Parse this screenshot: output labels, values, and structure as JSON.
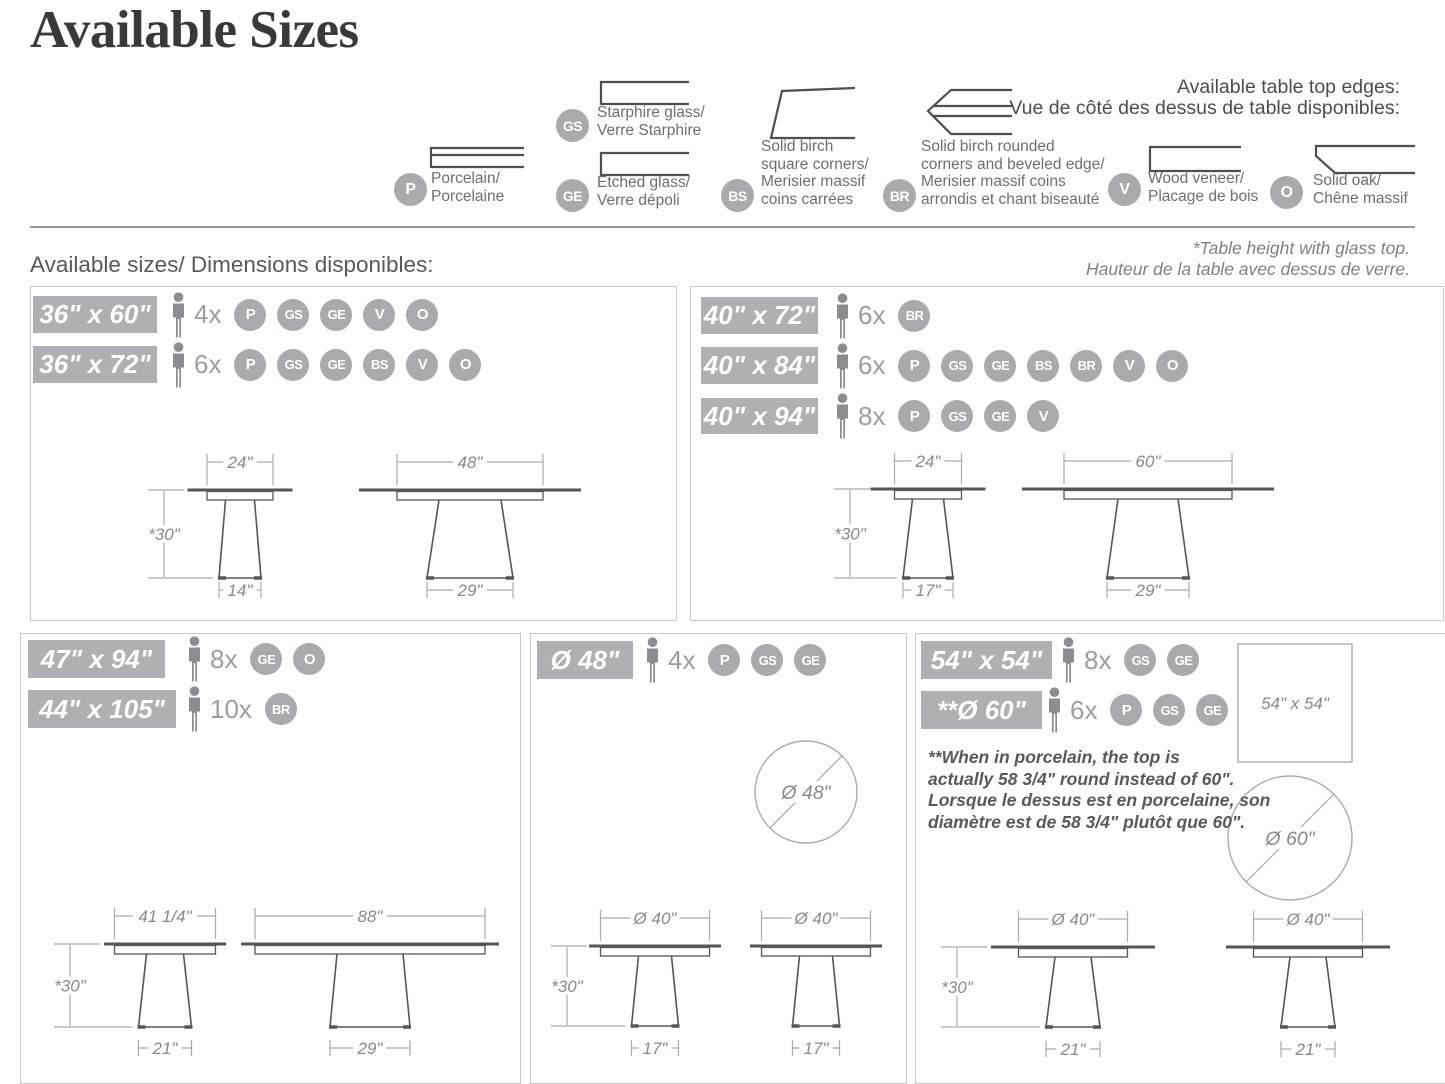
{
  "title": "Available Sizes",
  "colors": {
    "tag_bg": "#aeb0b3",
    "badge_bg": "#a8aaad",
    "table_line": "#54565a",
    "dim_line": "#a9abae",
    "dim_text": "#87898c",
    "profile_line": "#4d4f52",
    "person": "#8a8c8f"
  },
  "legend": {
    "heading_line1": "Available table top edges:",
    "heading_line2": "Vue de côté des dessus de table disponibles:",
    "items": [
      {
        "code": "P",
        "profile": "porcelain",
        "lines": [
          "Porcelain/",
          "Porcelaine"
        ]
      },
      {
        "code": "GS",
        "profile": "glass",
        "lines": [
          "Starphire glass/",
          "Verre Starphire"
        ]
      },
      {
        "code": "GE",
        "profile": "glass",
        "lines": [
          "Etched glass/",
          "Verre dépoli"
        ]
      },
      {
        "code": "BS",
        "profile": "birch-square",
        "lines": [
          "Solid birch",
          "square corners/",
          "Merisier massif",
          "coins carrées"
        ]
      },
      {
        "code": "BR",
        "profile": "birch-rounded",
        "lines": [
          "Solid birch rounded",
          "corners and beveled edge/",
          "Merisier massif coins",
          "arrondis et chant biseauté"
        ]
      },
      {
        "code": "V",
        "profile": "veneer",
        "lines": [
          "Wood veneer/",
          "Placage de bois"
        ]
      },
      {
        "code": "O",
        "profile": "oak",
        "lines": [
          "Solid oak/",
          "Chêne massif"
        ]
      }
    ]
  },
  "section_heading": "Available sizes/ Dimensions disponibles:",
  "height_note": {
    "en": "*Table height with glass top.",
    "fr": "Hauteur de la table avec dessus de verre."
  },
  "panels": [
    {
      "rows": [
        {
          "size": "36\" x 60\"",
          "count": "4x",
          "codes": [
            "P",
            "GS",
            "GE",
            "V",
            "O"
          ]
        },
        {
          "size": "36\" x 72\"",
          "count": "6x",
          "codes": [
            "P",
            "GS",
            "GE",
            "BS",
            "V",
            "O"
          ]
        }
      ]
    },
    {
      "rows": [
        {
          "size": "40\" x 72\"",
          "count": "6x",
          "codes": [
            "BR"
          ]
        },
        {
          "size": "40\" x 84\"",
          "count": "6x",
          "codes": [
            "P",
            "GS",
            "GE",
            "BS",
            "BR",
            "V",
            "O"
          ]
        },
        {
          "size": "40\" x 94\"",
          "count": "8x",
          "codes": [
            "P",
            "GS",
            "GE",
            "V"
          ]
        }
      ]
    },
    {
      "rows": [
        {
          "size": "47\" x 94\"",
          "count": "8x",
          "codes": [
            "GE",
            "O"
          ]
        },
        {
          "size": "44\" x 105\"",
          "count": "10x",
          "codes": [
            "BR"
          ]
        }
      ]
    },
    {
      "rows": [
        {
          "size": "Ø 48\"",
          "count": "4x",
          "codes": [
            "P",
            "GS",
            "GE"
          ]
        }
      ]
    },
    {
      "rows": [
        {
          "size": "54\" x 54\"",
          "count": "8x",
          "codes": [
            "GS",
            "GE"
          ]
        },
        {
          "size": "**Ø 60\"",
          "count": "6x",
          "codes": [
            "P",
            "GS",
            "GE"
          ]
        }
      ],
      "note_lines": [
        "**When in porcelain, the top is",
        "actually 58 3/4\" round instead of 60\".",
        "Lorsque le dessus est en porcelaine, son",
        "diamètre est de 58 3/4\" plutôt que 60\"."
      ]
    }
  ],
  "drawings": {
    "tables": [
      {
        "top": "24\"",
        "height": "*30\"",
        "base": "14\""
      },
      {
        "top": "48\"",
        "height": "",
        "base": "29\""
      },
      {
        "top": "24\"",
        "height": "*30\"",
        "base": "17\""
      },
      {
        "top": "60\"",
        "height": "",
        "base": "29\""
      },
      {
        "top": "41 1/4\"",
        "height": "*30\"",
        "base": "21\""
      },
      {
        "top": "88\"",
        "height": "",
        "base": "29\""
      },
      {
        "top": "Ø 40\"",
        "height": "*30\"",
        "base": "17\""
      },
      {
        "top": "Ø 40\"",
        "height": "",
        "base": "17\""
      },
      {
        "top": "Ø 40\"",
        "height": "*30\"",
        "base": "21\""
      },
      {
        "top": "Ø 40\"",
        "height": "",
        "base": "21\""
      }
    ],
    "circles": [
      {
        "label": "Ø 48\""
      },
      {
        "label": "Ø 60\""
      }
    ],
    "square": {
      "label": "54\" x 54\""
    }
  }
}
